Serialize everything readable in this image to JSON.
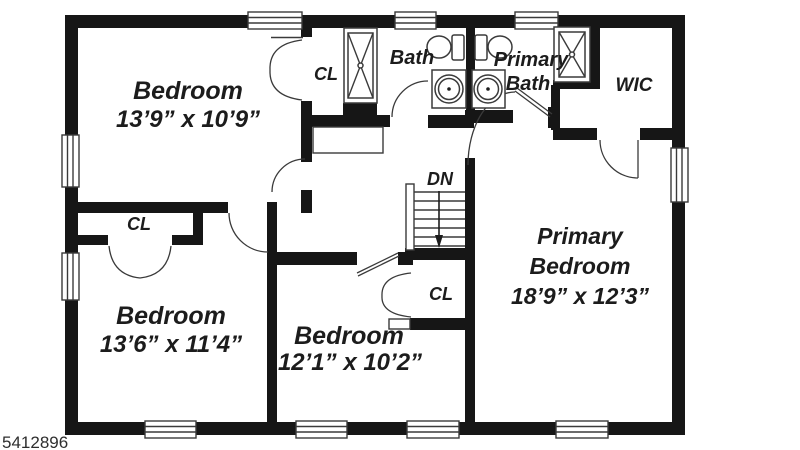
{
  "plan": {
    "bedroom_top_left": {
      "name": "Bedroom",
      "dims": "13’9” x 10’9”"
    },
    "bedroom_bottom_left": {
      "name": "Bedroom",
      "dims": "13’6” x 11’4”"
    },
    "bedroom_bottom_mid": {
      "name": "Bedroom",
      "dims": "12’1” x 10’2”"
    },
    "primary_bedroom": {
      "line1": "Primary",
      "line2": "Bedroom",
      "dims": "18’9” x 12’3”"
    },
    "bath": {
      "label": "Bath"
    },
    "primary_bath": {
      "line1": "Primary",
      "line2": "Bath"
    },
    "wic": {
      "label": "WIC"
    },
    "closet_top": {
      "label": "CL"
    },
    "closet_left": {
      "label": "CL"
    },
    "closet_middle": {
      "label": "CL"
    },
    "stairs": {
      "label": "DN"
    }
  },
  "watermark": {
    "id_text": "5412896"
  },
  "colors": {
    "wall": "#161616",
    "floor": "#ffffff",
    "line": "#3a3a3a",
    "text": "#1c1c1c",
    "watermark": "#2e2e2e"
  }
}
